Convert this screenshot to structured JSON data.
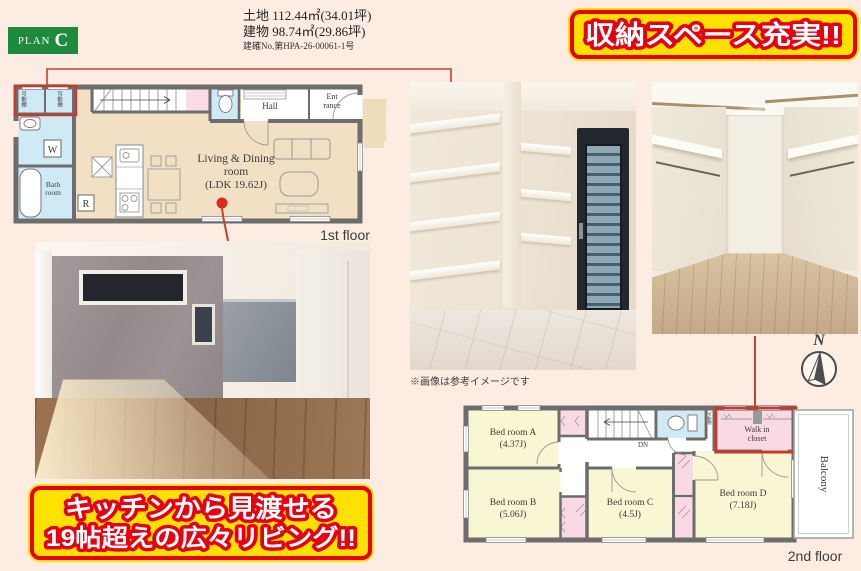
{
  "header": {
    "plan_badge": {
      "prefix": "PLAN",
      "letter": "C"
    },
    "land_area": "土地 112.44㎡(34.01坪)",
    "building_area": "建物 98.74㎡(29.86坪)",
    "permit_no": "建確No.第HPA-26-00061-1号",
    "storage_banner": "収納スペース充実!!"
  },
  "living_banner": {
    "line1": "キッチンから見渡せる",
    "line2": "19帖超えの広々リビング!!"
  },
  "floor1": {
    "caption": "1st floor",
    "labels": {
      "shelf_left": "可動棚",
      "shelf_right": "可動棚",
      "washer": "W",
      "bath1": "Bath",
      "bath2": "room",
      "hall": "Hall",
      "ent1": "Ent",
      "ent2": "rance",
      "ldk1": "Living & Dining",
      "ldk2": "room",
      "ldk3": "(LDK 19.62J)",
      "fridge": "R"
    }
  },
  "floor2": {
    "caption": "2nd floor",
    "labels": {
      "bedroom_a1": "Bed room A",
      "bedroom_a2": "(4.37J)",
      "bedroom_b1": "Bed room B",
      "bedroom_b2": "(5.06J)",
      "bedroom_c1": "Bed room C",
      "bedroom_c2": "(4.5J)",
      "bedroom_d1": "Bed room D",
      "bedroom_d2": "(7.18J)",
      "wic1": "Walk in",
      "wic2": "closet",
      "wic_shelf": "可動棚",
      "balcony": "Balcony",
      "down": "DN"
    }
  },
  "photos": {
    "disclaimer": "※画像は参考イメージです"
  },
  "compass": {
    "north": "N"
  },
  "colors": {
    "background": "#fcece1",
    "plan_green": "#1e8a3d",
    "banner_yellow": "#ffe100",
    "banner_red": "#e50014",
    "callout_red": "#c5402e",
    "wall_gray": "#6d6d6d",
    "room_blue": "#cfe9f5",
    "room_pink": "#f9d9e6",
    "room_yellow": "#f9f6d3",
    "floor_beige": "#f2e0c4"
  }
}
